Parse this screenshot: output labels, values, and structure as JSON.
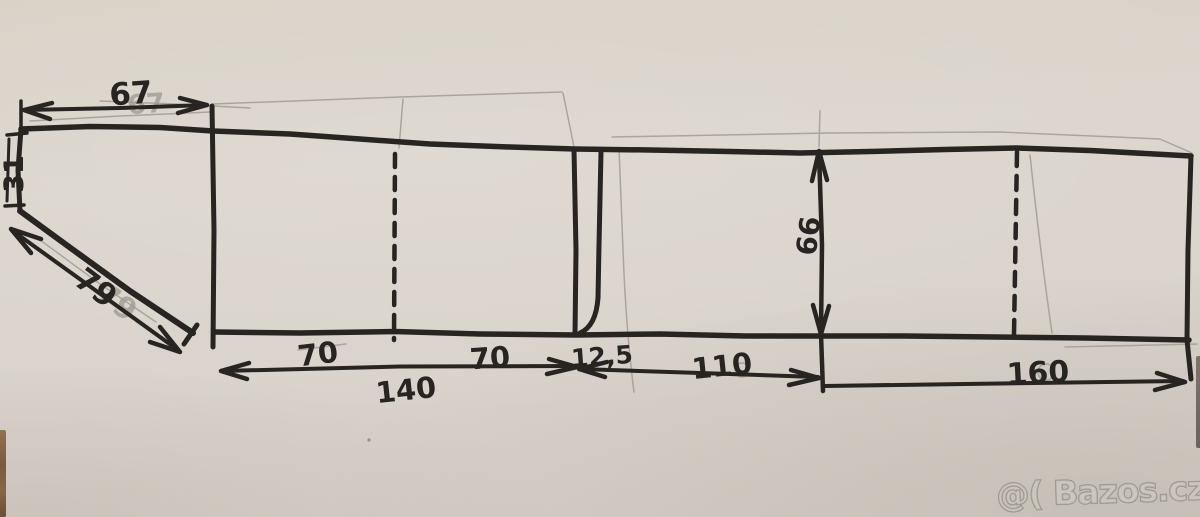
{
  "colors": {
    "paper": "#d9d3cb",
    "ink": "#272421",
    "pencil": "#a29d94",
    "watermark_fill": "rgba(208,203,196,0.50)",
    "watermark_stroke": "rgba(110,105,98,0.55)"
  },
  "dimensions": {
    "top_width": "67",
    "left_height": "31",
    "diagonal_length": "79",
    "left_half_a": "70",
    "left_half_b": "70",
    "left_total": "140",
    "narrow_strip": "12,5",
    "middle_width": "110",
    "depth": "66",
    "right_width": "160"
  },
  "watermark": {
    "text": "@( Bazos.cz"
  }
}
